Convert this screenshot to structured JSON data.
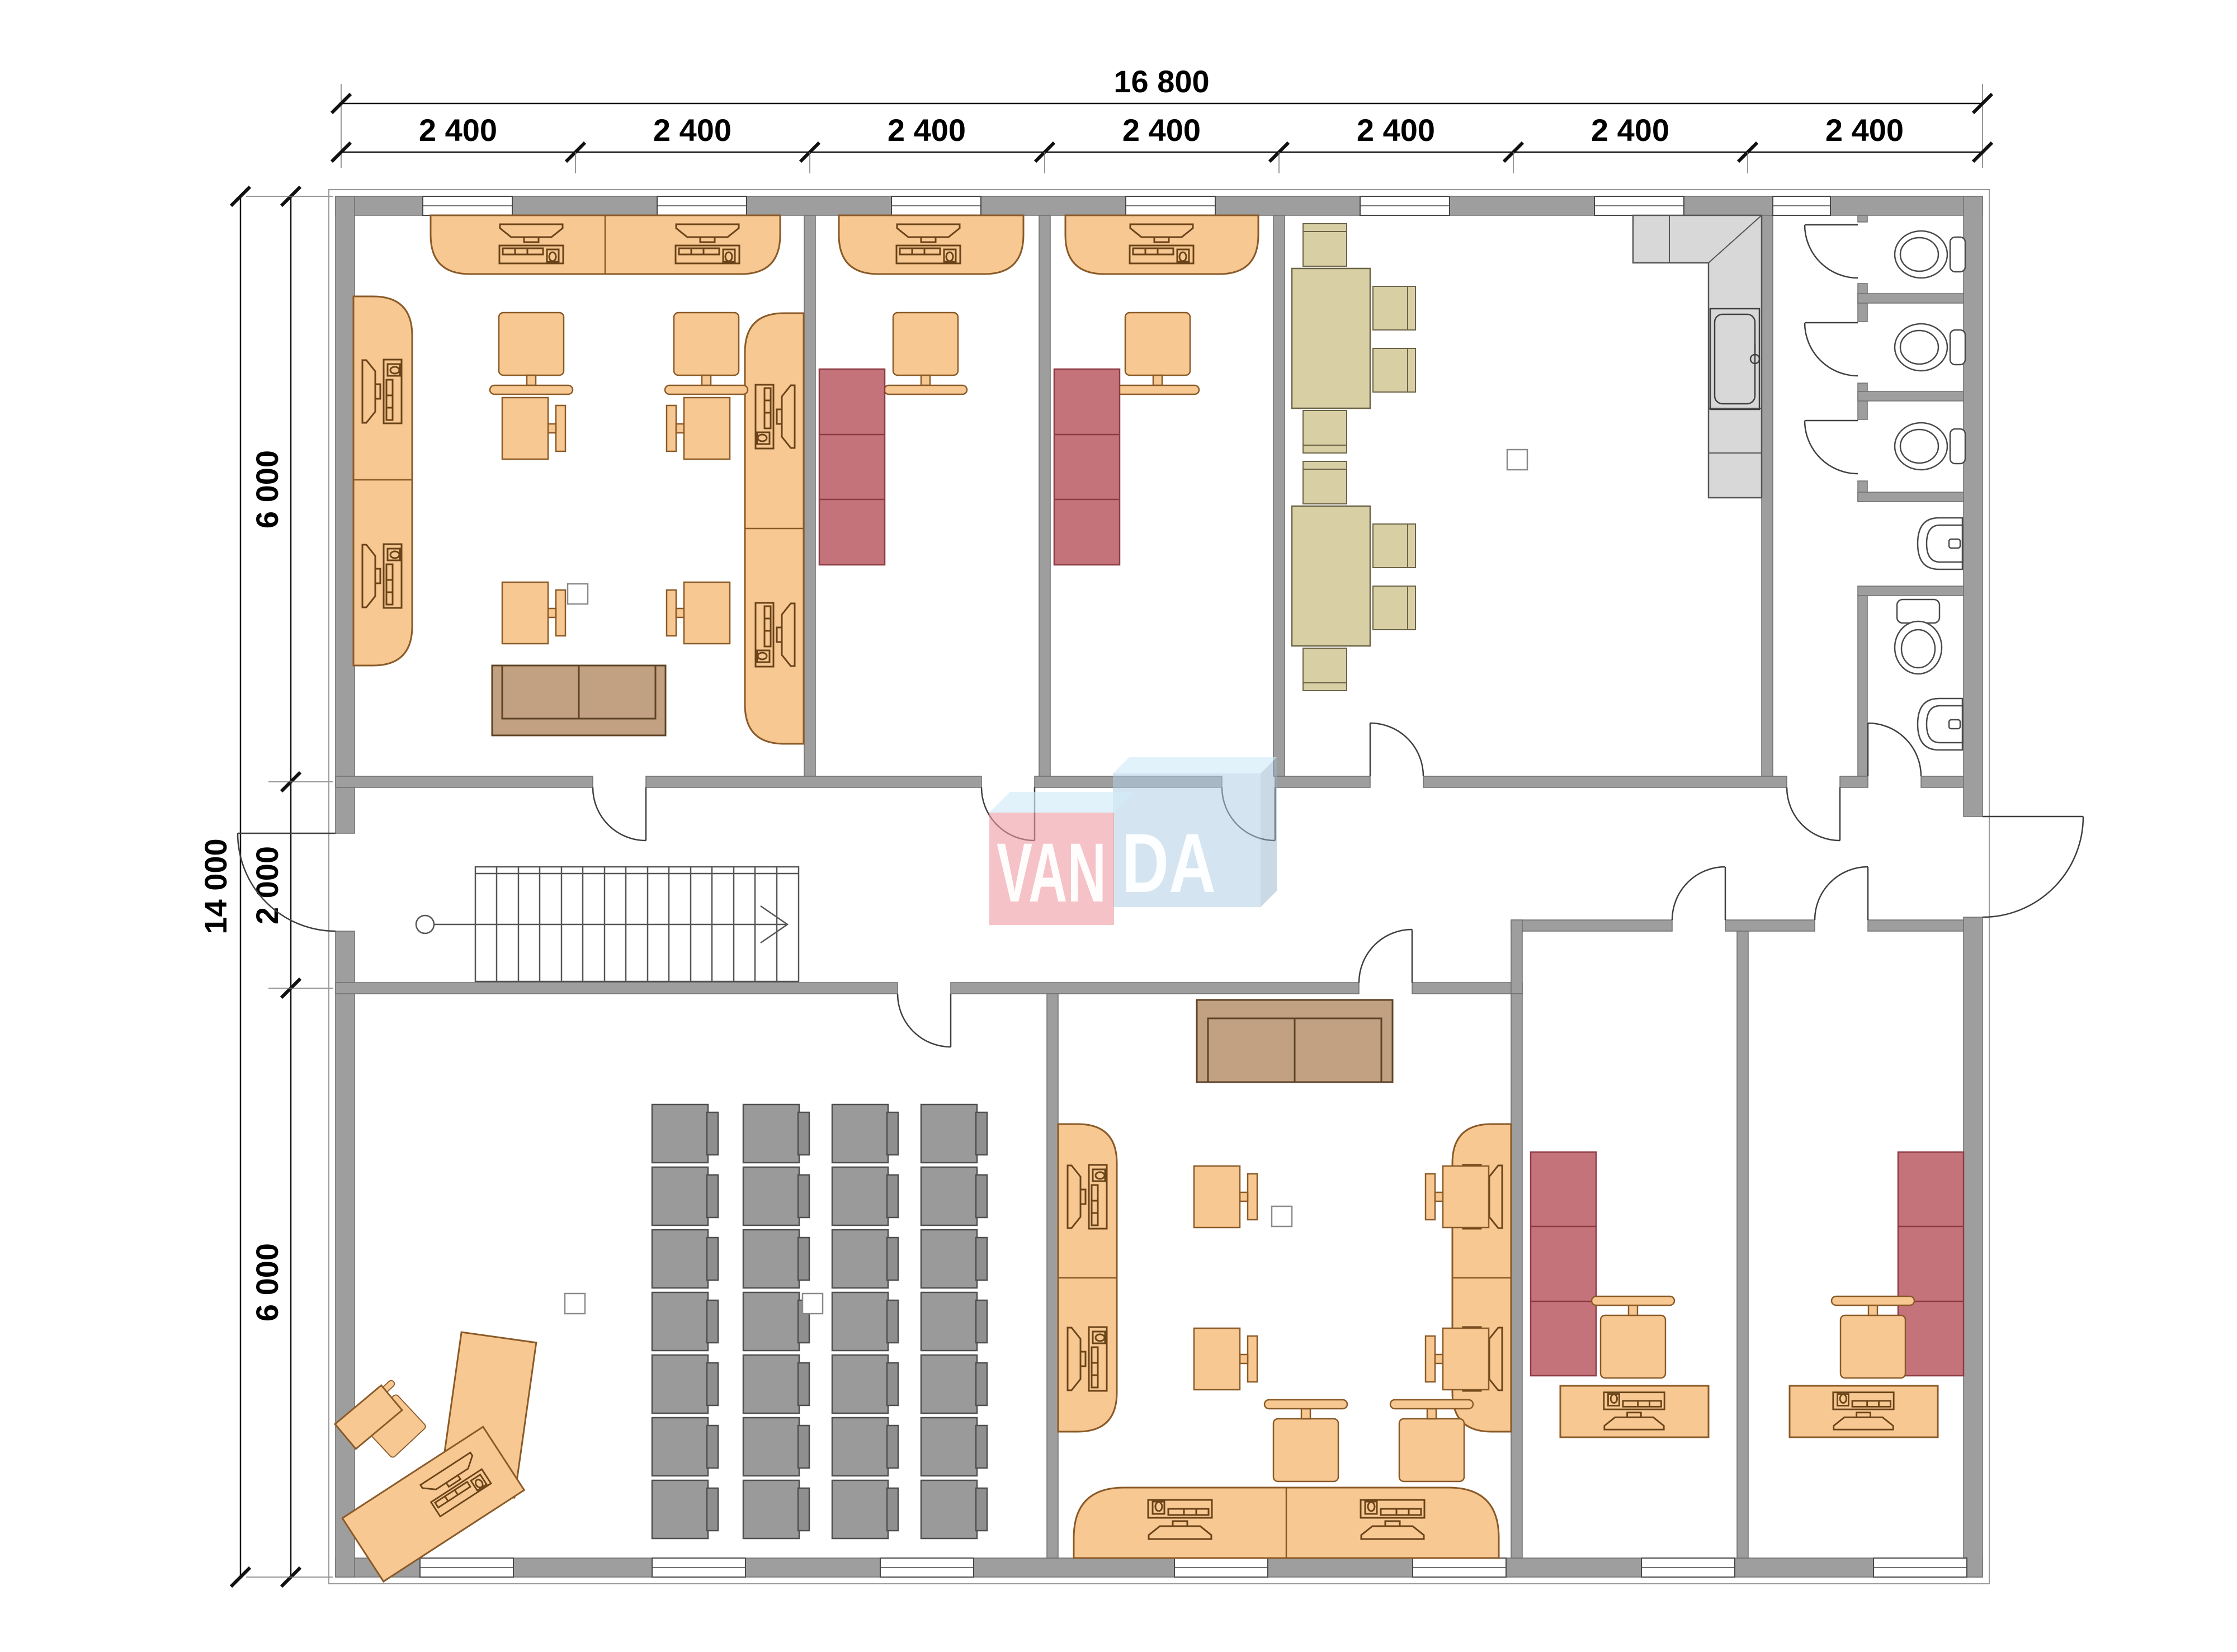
{
  "watermark": {
    "brand": "VANDA",
    "left": "VAN",
    "right": "DA"
  },
  "dimensions": {
    "total_width_label": "16 800",
    "bay_labels": [
      "2 400",
      "2 400",
      "2 400",
      "2 400",
      "2 400",
      "2 400",
      "2 400"
    ],
    "total_height_label": "14 000",
    "height_segment_labels": [
      "6 000",
      "2 000",
      "6 000"
    ]
  },
  "colors": {
    "wall_gray": "#9e9e9e",
    "furniture_orange": "#f8c893",
    "furniture_outline_brown": "#8a5a28",
    "shelf_red": "#c5737b",
    "table_beige": "#d9cfa5",
    "classroom_desk_gray": "#9a9a9a",
    "sofa_brown": "#c2a183",
    "kitchen_gray": "#d8d8d8",
    "logo_pink": "#eea0a8",
    "logo_blue": "#b0cee6",
    "logo_top_blue": "#d3ebf7",
    "dimension_line_black": "#111111"
  },
  "icons": [
    "wall",
    "window-icon",
    "door-swing-icon",
    "stairs-icon",
    "column-marker",
    "counter-desk",
    "computer-workstation-icon",
    "office-chair-icon",
    "desk-chair-pair-icon",
    "sofa-icon",
    "red-shelf-icon",
    "beige-table",
    "beige-chair-icon",
    "classroom-desk-icon",
    "teacher-desk",
    "kitchen-counter",
    "kitchen-sink-icon",
    "toilet-icon",
    "wash-basin-icon"
  ]
}
